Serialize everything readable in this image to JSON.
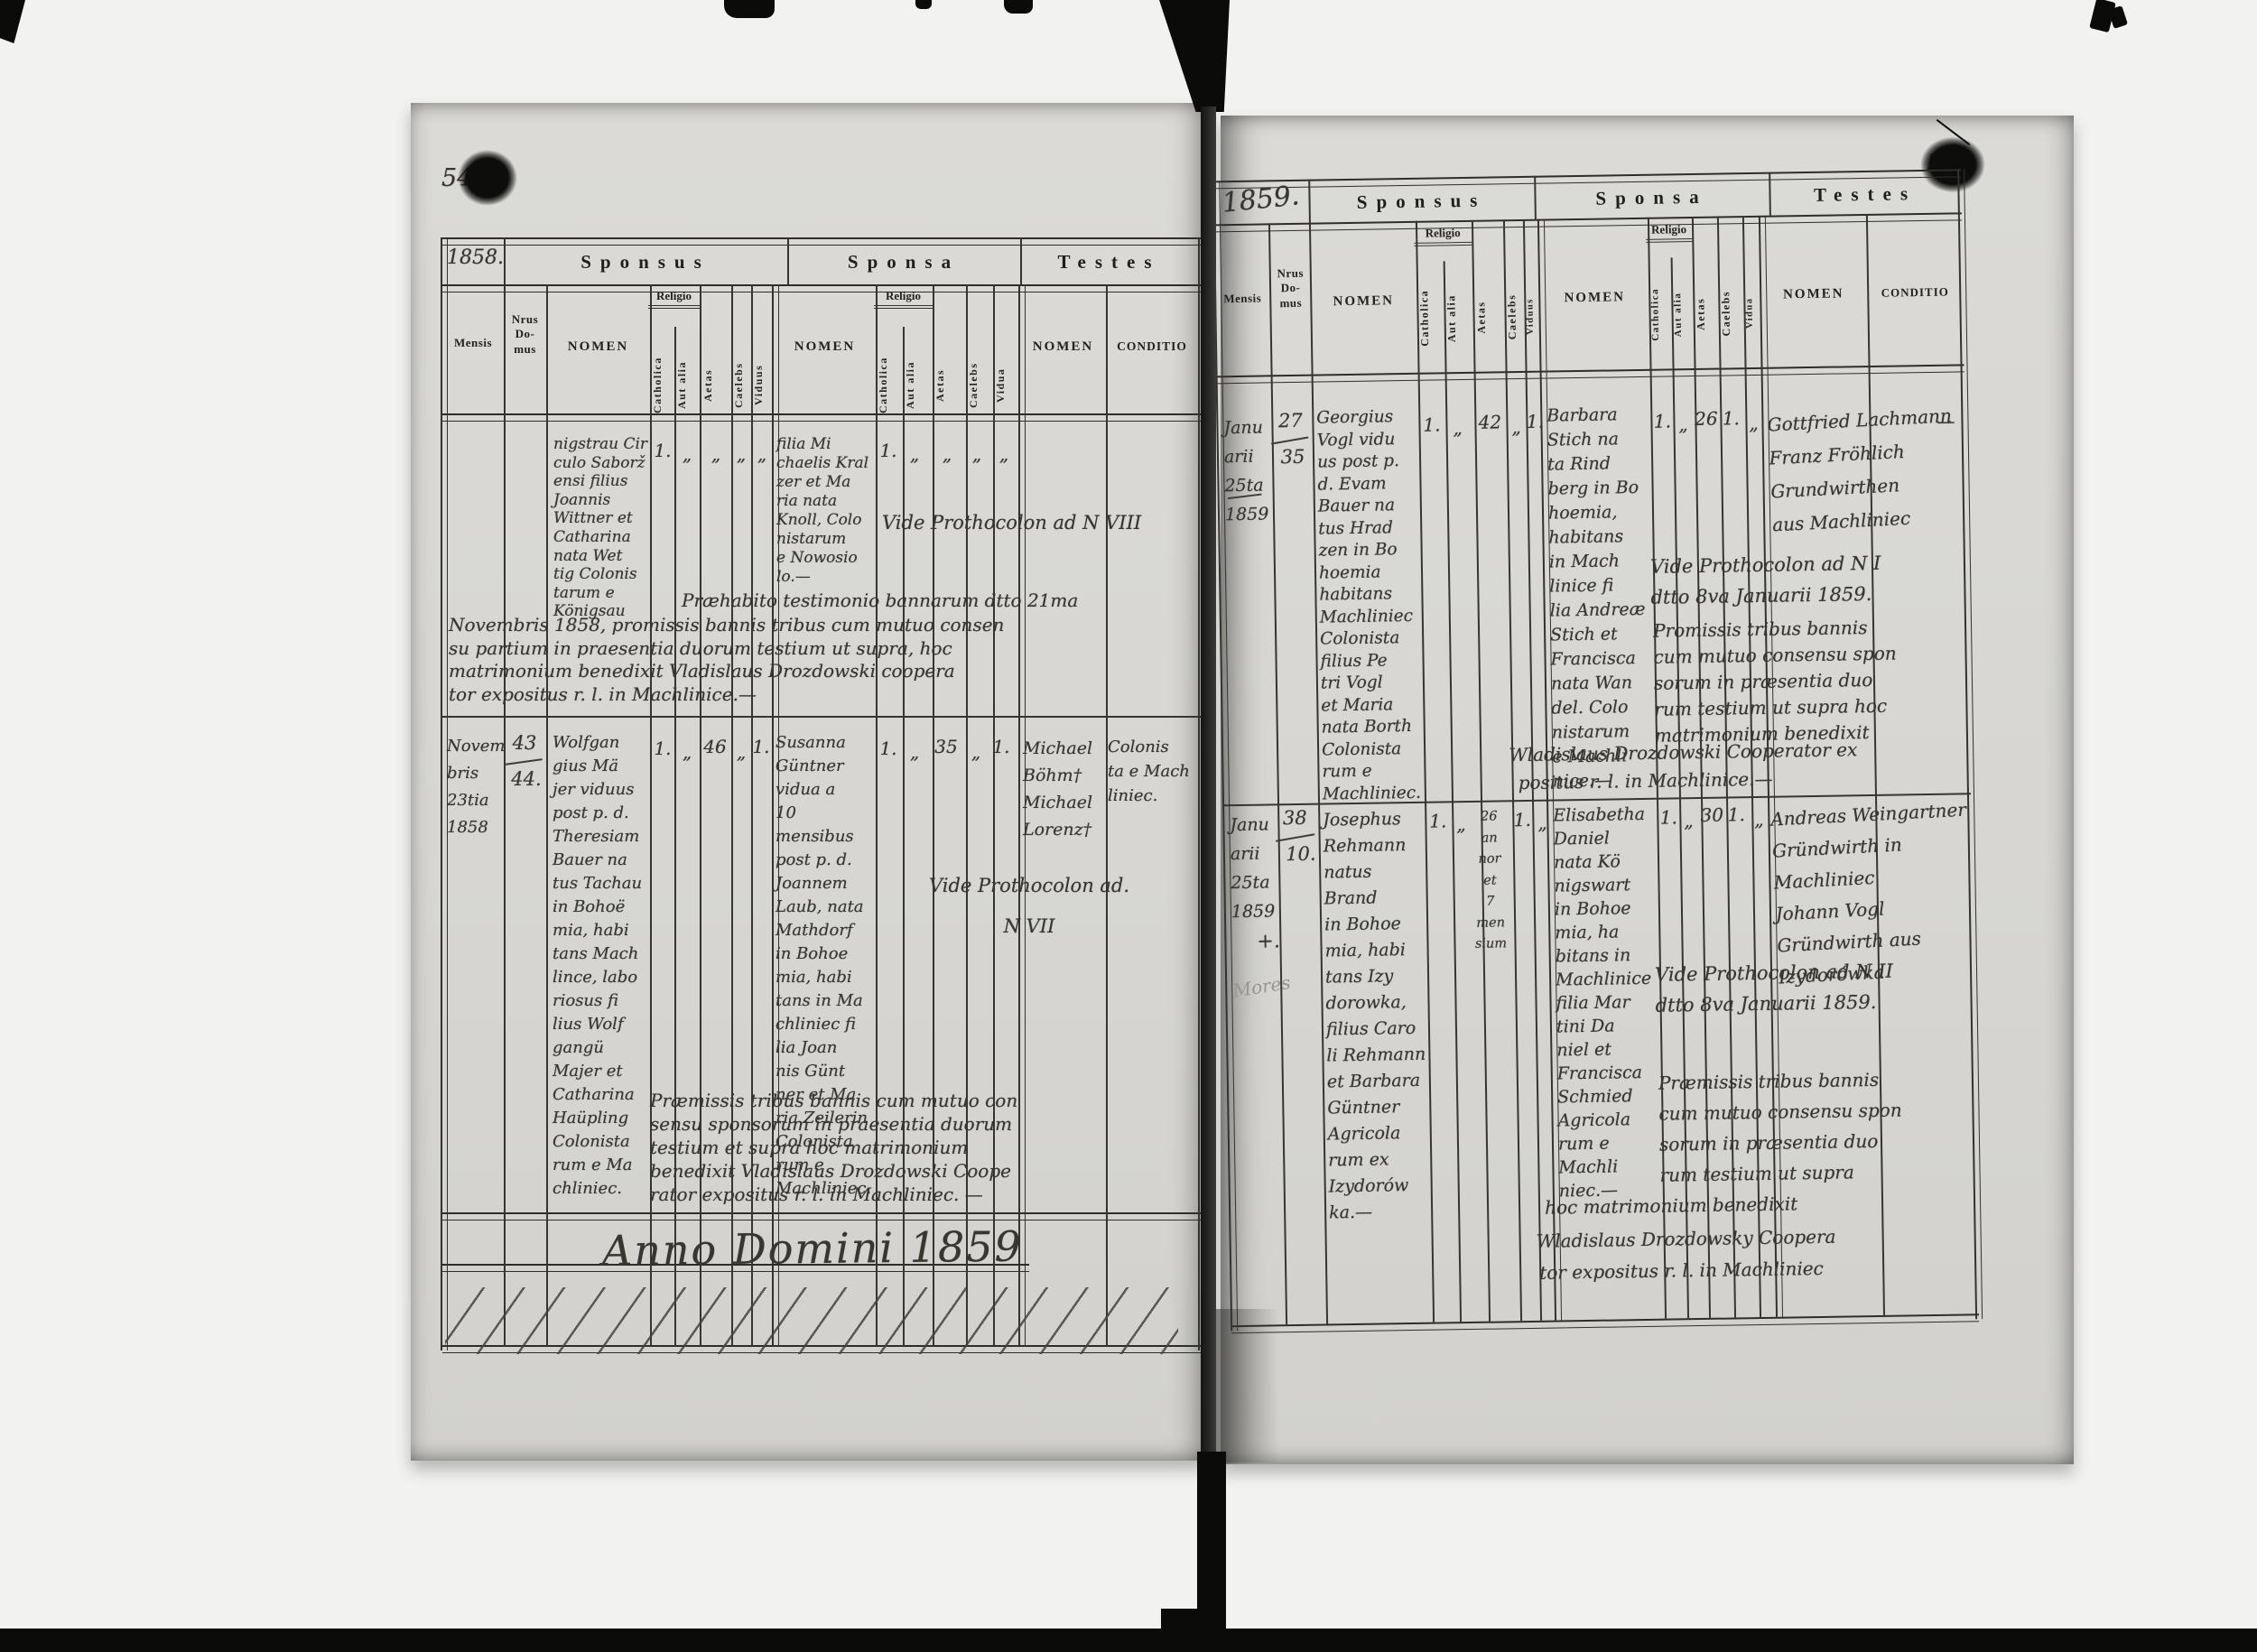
{
  "sections": {
    "sponsus": "Sponsus",
    "sponsa": "Sponsa",
    "testes": "Testes"
  },
  "columns": {
    "mensis": "Mensis",
    "nrus": "Nrus\nDo-\nmus",
    "nomen": "NOMEN",
    "religio": "Religio",
    "catholica": "Catholica",
    "aut_alia": "Aut alia",
    "aetas": "Aetas",
    "caelebs": "Caelebs",
    "viduus": "Viduus",
    "vidua": "Vidua",
    "conditio": "CONDITIO"
  },
  "left": {
    "page_number": "54",
    "year": "1858.",
    "r1": {
      "sponsus_nomen": "nigstrau Cir\nculo Saborž\nensi filius\nJoannis\nWittner et\nCatharina\nnata Wet\ntig Colonis\ntarum e\nKönigsau",
      "sp": {
        "cath": "1.",
        "aut": "„",
        "aetas": "„",
        "cael": "„",
        "vid": "„"
      },
      "sponsa_nomen": "filia Mi\nchaelis Kral\nzer et Ma\nria nata\nKnoll, Colo\nnistarum\ne Nowosio\nlo.—",
      "sa": {
        "cath": "1.",
        "aut": "„",
        "aetas": "„",
        "cael": "„",
        "vid": "„"
      },
      "vide": "Vide Prothocolon ad N VIII",
      "note_line1": "Præhabito testimonio bannarum dtto 21ma",
      "note_rest": "Novembris 1858, promissis bannis tribus cum mutuo consen\nsu partium in praesentia duorum testium ut supra, hoc\nmatrimonium benedixit Vladislaus Drozdowski coopera\ntor expositus r. l. in Machlinice.—"
    },
    "r2": {
      "mensis": "Novem\nbris\n23tia\n1858",
      "nrus_top": "43",
      "nrus_bottom": "44.",
      "sponsus_nomen": "Wolfgan\ngius Mä\njer viduus\npost p. d.\nTheresiam\nBauer na\ntus Tachau\nin Bohoë\nmia, habi\ntans Mach\nlince, labo\nriosus fi\nlius Wolf\ngangü\nMajer et\nCatharina\nHaüpling\nColonista\nrum e Ma\nchliniec.",
      "sp": {
        "cath": "1.",
        "aut": "„",
        "aetas": "46",
        "cael": "„",
        "vid": "1."
      },
      "sponsa_nomen": "Susanna\nGüntner\nvidua a\n10 mensibus\npost p. d.\nJoannem\nLaub, nata\nMathdorf\nin Bohoe\nmia, habi\ntans in Ma\nchliniec fi\nlia Joan\nnis Günt\nner et Ma\nria Zeilerin\nColonista\nrum e\nMachliniec.",
      "sa": {
        "cath": "1.",
        "aut": "„",
        "aetas": "35",
        "cael": "„",
        "vid": "1."
      },
      "testes_nomen": "Michael\nBöhm†\nMichael\nLorenz†",
      "conditio": "Colonis\nta e Mach\nliniec.",
      "vide": "Vide Prothocolon ad.\nN VII",
      "note": "Præmissis tribus bannis cum mutuo con\nsensu sponsorum in praesentia duorum\ntestium et supra hoc matrimonium\nbenedixit Vladislaus Drozdowski Coope\nrator expositus r. l. in Machliniec. —"
    },
    "anno_domini": "Anno Domini 1859"
  },
  "right": {
    "page_number": "55",
    "year": "1859.",
    "r1": {
      "mensis": "Janu\narii\n25ta\n1859",
      "nrus_top": "27",
      "nrus_bottom": "35",
      "sponsus_nomen": "Georgius\nVogl vidu\nus post p.\nd. Evam\nBauer na\ntus Hrad\nzen in Bo\nhoemia\nhabitans\nMachliniec\nColonista\nfilius Pe\ntri Vogl\net Maria\nnata Borth\nColonista\nrum e\nMachliniec.",
      "sp": {
        "cath": "1.",
        "aut": "„",
        "aetas": "42",
        "cael": "„",
        "vid": "1."
      },
      "sponsa_nomen": "Barbara\nStich na\nta Rind\nberg in Bo\nhoemia,\nhabitans\nin Mach\nlinice fi\nlia Andreæ\nStich et\nFrancisca\nnata Wan\ndel. Colo\nnistarum\ne Machli\nnice.—",
      "sa": {
        "cath": "1.",
        "aut": "„",
        "aetas": "26",
        "cael": "1.",
        "vid": "„"
      },
      "testes_nomen": "Gottfried Lachmann\nFranz Fröhlich\nGrundwirthen\naus Machliniec",
      "margin_dash": "—",
      "vide": "Vide Prothocolon ad N I\ndtto 8va Januarii 1859.",
      "note": "Promissis tribus bannis\ncum mutuo consensu spon\nsorum in præsentia duo\nrum testium ut supra hoc\nmatrimonium benedixit",
      "note_wide1": "Wladislaus Drozdowski Cooperator ex",
      "note_wide2": "positus r. l. in Machlinice.—"
    },
    "r2": {
      "mensis": "Janu\narii\n25ta\n1859",
      "cross": "+.",
      "pencil": "Mores",
      "nrus_top": "38",
      "nrus_bottom": "10.",
      "sponsus_nomen": "Josephus\nRehmann\nnatus Brand\nin Bohoe\nmia, habi\ntans Izy\ndorowka,\nfilius Caro\nli Rehmann\net Barbara\nGüntner\nAgricola\nrum ex\nIzydorów\nka.—",
      "sp": {
        "cath": "1.",
        "aut": "„",
        "aetas": "26\nan\nnor\net\n7\nmen\nsium",
        "cael": "1.",
        "vid": "„"
      },
      "sponsa_nomen": "Elisabetha\nDaniel\nnata Kö\nnigswart\nin Bohoe\nmia, ha\nbitans in\nMachlinice\nfilia Mar\ntini Da\nniel et\nFrancisca\nSchmied\nAgricola\nrum e\nMachli\nniec.—",
      "sa": {
        "cath": "1.",
        "aut": "„",
        "aetas": "30",
        "cael": "1.",
        "vid": "„"
      },
      "testes_nomen": "Andreas Weingartner\nGründwirth in\nMachliniec\nJohann Vogl\nGründwirth aus\nIzydorówka",
      "vide": "Vide Prothocolon ad N II\ndtto 8va Januarii 1859.",
      "note": "Præmissis tribus bannis\ncum mutuo consensu spon\nsorum in præsentia duo\nrum testium ut supra",
      "note_wide1": "hoc matrimonium benedixit",
      "note_wide2": "Wladislaus Drozdowsky Coopera",
      "note_wide3": "tor expositus r. l. in Machliniec"
    }
  }
}
